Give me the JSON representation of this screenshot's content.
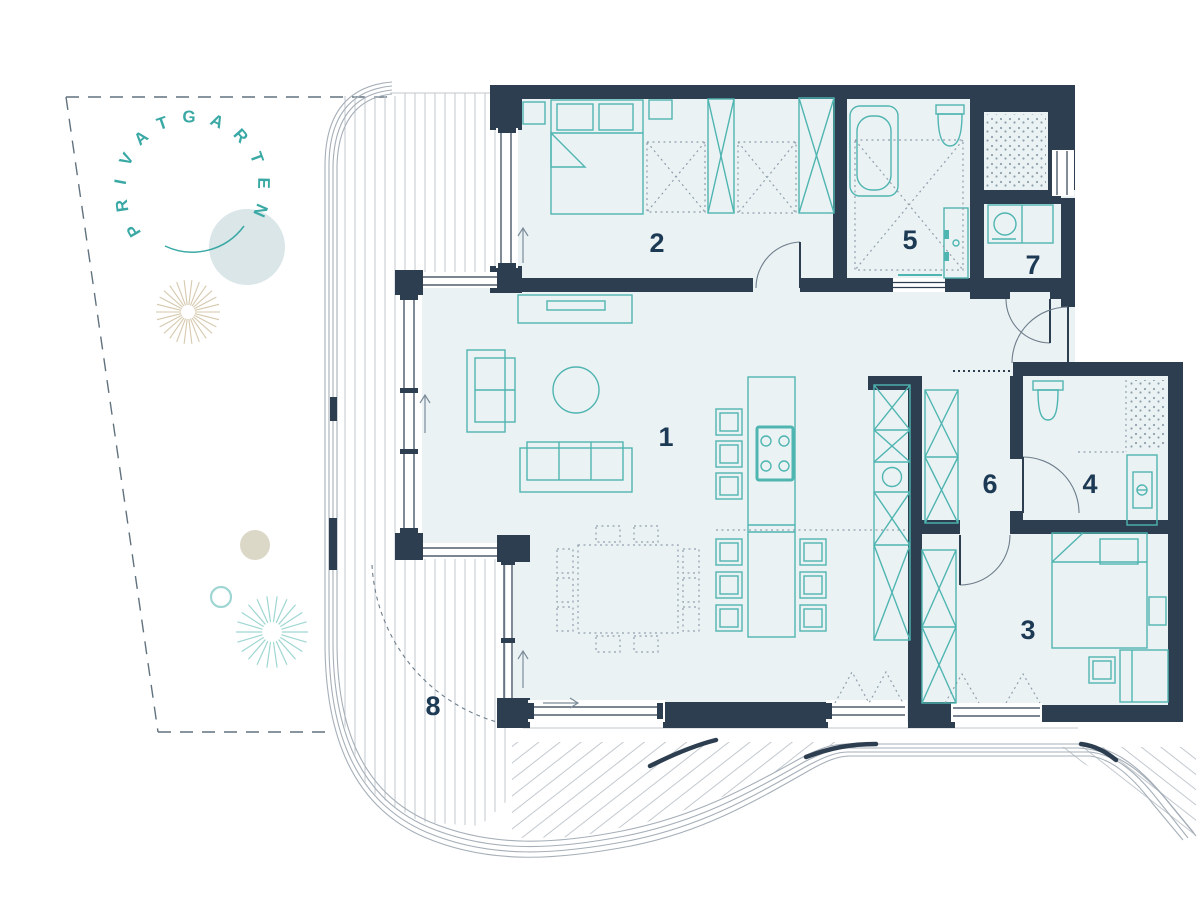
{
  "garden": {
    "label": "PRIVATGARTEN"
  },
  "rooms": {
    "r1": {
      "label": "1"
    },
    "r2": {
      "label": "2"
    },
    "r3": {
      "label": "3"
    },
    "r4": {
      "label": "4"
    },
    "r5": {
      "label": "5"
    },
    "r6": {
      "label": "6"
    },
    "r7": {
      "label": "7"
    },
    "r8": {
      "label": "8"
    }
  },
  "colors": {
    "wall": "#2d3e51",
    "floor": "#ebf2f4",
    "furniture_teal": "#4fb5b1",
    "deck_line": "#c3c9cf",
    "curve_line": "#a6afb8",
    "dot_gray": "#8fa0ad",
    "garden_teal": "#3aa9a5",
    "garden_teal_light": "#9fd6d3",
    "garden_tan": "#d6c9ae",
    "garden_beige": "#dcd8c8",
    "garden_circle": "#dbe6e9",
    "label_navy": "#1d3a55"
  }
}
